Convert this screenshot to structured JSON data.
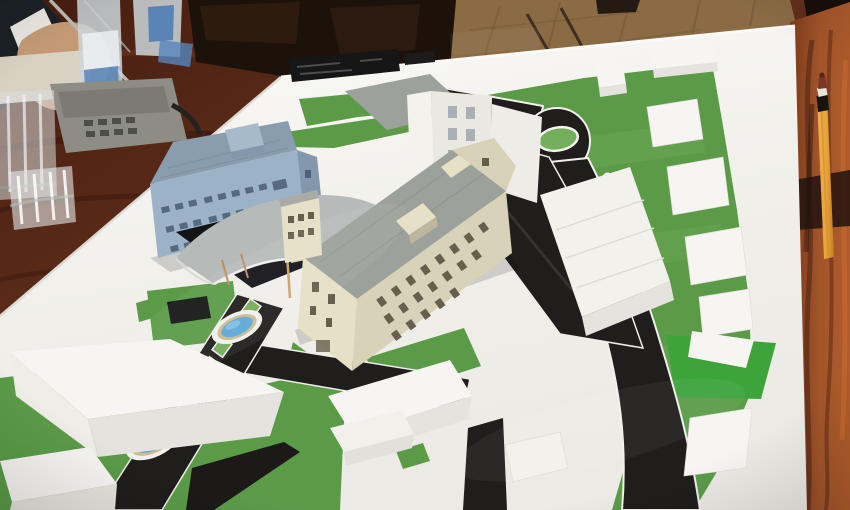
{
  "meta": {
    "type": "photograph",
    "caption": "Architectural scale model of a hospital/campus complex on a white baseboard, presented on a dark polished wooden conference table; a hand with a pen, water bottles, glasses and a conference phone sit at the top left, parquet floor shows at the top right, and a pencil stands along the right table edge."
  },
  "palette": {
    "wood-dark": "#451d0f",
    "wood-mid": "#5f2b18",
    "wood-streak": "#2b1108",
    "wood-hi": "#8a4526",
    "wood-right": "#a2552a",
    "wood-right-dark": "#431e0f",
    "wood-right-bright": "#c86b2e",
    "floor": "#8a6b44",
    "floor-line": "#6e5335",
    "shadow-dark": "#1d120a",
    "board": "#f1f0eb",
    "board-bright": "#fbfaf7",
    "board-shade": "#e2e0d8",
    "grass": "#5b9b48",
    "grass-light": "#74ad5c",
    "grass-bright": "#3da33b",
    "road": "#1f1e1c",
    "water": "#5fa8d8",
    "water-light": "#8cc4e8",
    "pond-ring": "#cbbc92",
    "model-white": "#f6f5f1",
    "model-white-shade": "#e5e3dd",
    "cream": "#d8d2b8",
    "cream-light": "#e6e0c7",
    "cream-shade": "#bdb79f",
    "blue-wall": "#9cb2c7",
    "blue-side": "#8398ac",
    "blue-roof": "#8a9dae",
    "window-blue": "#50627a",
    "window-cream": "#665f4e",
    "window-white": "#a8afb5",
    "roof-gray": "#9da19b",
    "canopy": "#b6bbba",
    "canopy-under": "#131318",
    "plaque": "#161616",
    "suit": "#1c2127",
    "cuff": "#e9e7e1",
    "skin": "#c49a76",
    "phone": "#8d8d85",
    "paper": "#d9d2c2",
    "bottle-label": "#4a7ab5",
    "pencil": "#e8a33c",
    "pencil-dark": "#c67d1f",
    "pencil-tip": "#7c3526"
  },
  "objects": {
    "table": "dark red-brown wooden conference table",
    "floor": "light brown parquet floor strip at top right",
    "board": "white model baseboard tilted in perspective",
    "name_plaque": "black name plate on board top edge (text illegible)",
    "grass_areas": "green lawn zones with lighter mowing stripes",
    "roads": "black asphalt loop road with white curbs, roundabout with green center island and teardrop median",
    "promenade": "black walkway with green paving squares and two oval blue ponds",
    "blue_building": "light blue three-story building with dark window rows and rooftop box",
    "canopy": "curved gray entrance canopy with cream elevator tower and wooden props",
    "cream_building": "long cream four-story building with gray flat roof and window grid",
    "white_tower": "tall white building with window grid and gray lower roof wing",
    "context_blocks": "plain white massing blocks and flat footprint plates",
    "green_platform": "bright green raised parcel with white plate at lower right",
    "hand": "person's hand in dark suit with white cuff holding a thin pen",
    "bottles": "plastic water bottles with blue labels",
    "glasses": "two clear drinking glasses",
    "phone": "gray conference telephone with dark cord",
    "pencil": "orange pencil standing along right table edge"
  }
}
